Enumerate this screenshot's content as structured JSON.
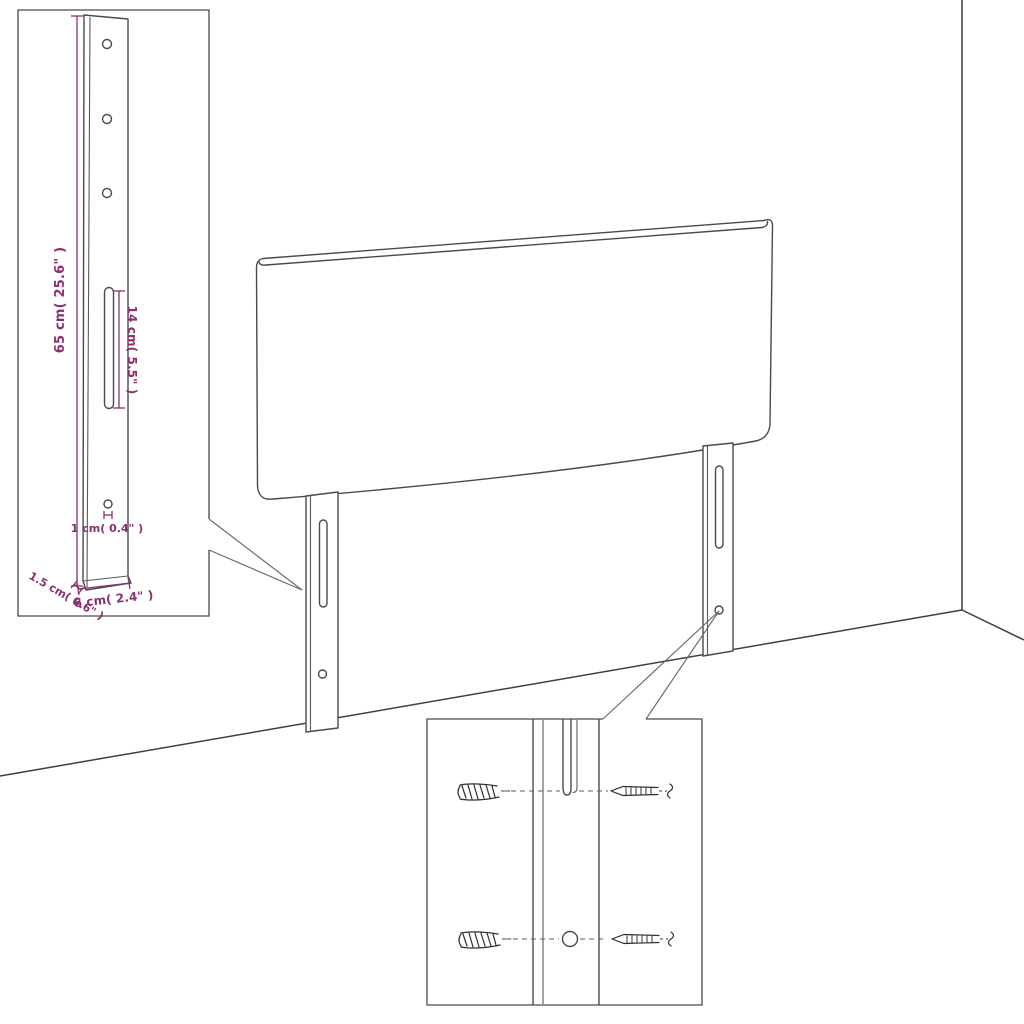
{
  "diagram": {
    "subject": "headboard-assembly-diagram",
    "insets": {
      "leg_detail": {
        "labels": {
          "height": "65 cm( 25.6\" )",
          "slot": "14 cm( 5.5\" )",
          "hole": "1 cm( 0.4\" )",
          "thickness": "1.5 cm( 0.6\" )",
          "width": "6 cm( 2.4\" )"
        }
      }
    },
    "colors": {
      "dimension_text": "#8b2f6e",
      "line_art": "#4a4a4a",
      "background": "#ffffff"
    }
  }
}
